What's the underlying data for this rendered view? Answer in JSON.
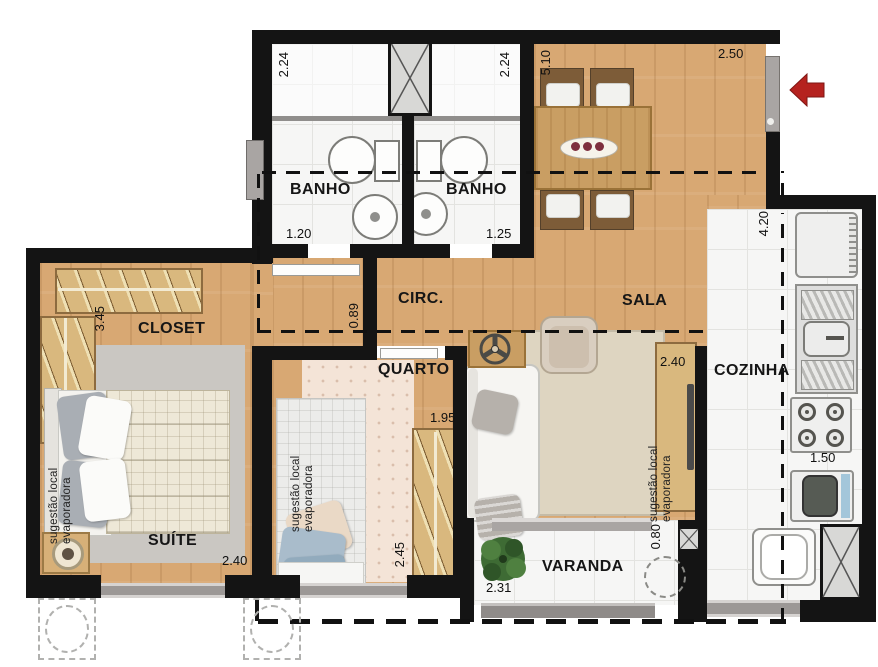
{
  "rooms": {
    "banho1": {
      "label": "BANHO",
      "dim_depth": "2.24",
      "dim_width": "1.20"
    },
    "banho2": {
      "label": "BANHO",
      "dim_depth": "2.24",
      "dim_width": "1.25"
    },
    "circ": {
      "label": "CIRC.",
      "dim_opening": "0.89"
    },
    "sala": {
      "label": "SALA",
      "dim_depth": "5.10",
      "dim_entry": "2.50",
      "dim_tv_wall": "2.40"
    },
    "closet": {
      "label": "CLOSET",
      "dim_depth": "3.45"
    },
    "suite": {
      "label": "SUÍTE",
      "dim_width": "2.40"
    },
    "quarto": {
      "label": "QUARTO",
      "dim_depth": "2.45",
      "dim_wardrobe": "1.95"
    },
    "cozinha": {
      "label": "COZINHA",
      "dim_depth": "4.20",
      "dim_width": "1.50"
    },
    "varanda": {
      "label": "VARANDA",
      "dim_width": "2.31",
      "dim_opening": "0.80"
    }
  },
  "annotations": {
    "evap_line1": "sugestão local",
    "evap_line2": "evaporadora"
  },
  "colors": {
    "wall": "#141414",
    "wood_floor": "#d8a873",
    "entry_arrow": "#b5221f"
  }
}
